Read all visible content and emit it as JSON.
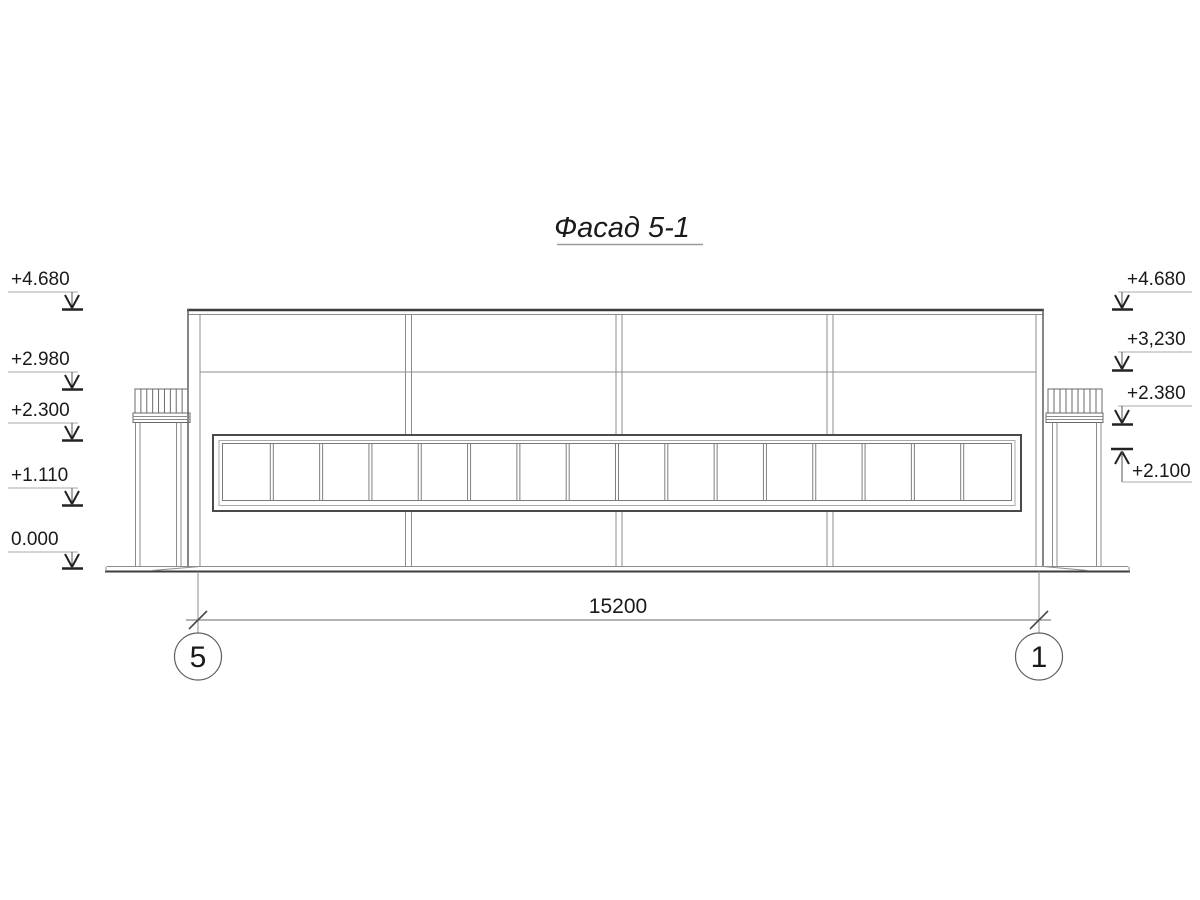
{
  "title": "Фасад 5-1",
  "marks_left": [
    {
      "label": "+4.680"
    },
    {
      "label": "+2.980"
    },
    {
      "label": "+2.300"
    },
    {
      "label": "+1.110"
    },
    {
      "label": "0.000"
    }
  ],
  "marks_right": [
    {
      "label": "+4.680"
    },
    {
      "label": "+3,230"
    },
    {
      "label": "+2.380"
    },
    {
      "label": "+2.100"
    }
  ],
  "dimension": {
    "value": "15200"
  },
  "axes": [
    {
      "label": "5"
    },
    {
      "label": "1"
    }
  ],
  "window_band": {
    "panes": 16
  },
  "canopies": {
    "hatch_lines": 8
  },
  "colors": {
    "heavy_line": "#3d3d3d",
    "medium_line": "#5f5f5f",
    "light_line": "#8c8c8c",
    "xlight_line": "#a9a9a9",
    "text": "#1a1a1a"
  }
}
